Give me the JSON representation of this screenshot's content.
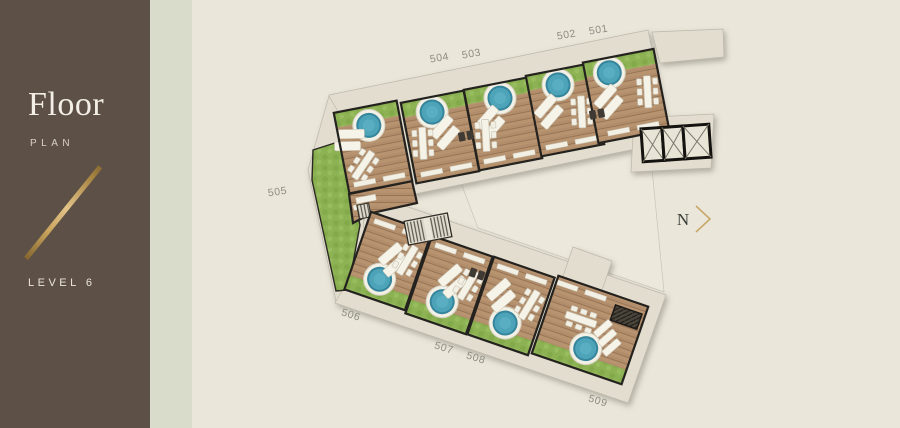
{
  "sidebar": {
    "title": "Floor",
    "subtitle": "PLAN",
    "level_label": "LEVEL 6"
  },
  "plan": {
    "north_label": "N",
    "units": [
      {
        "label": "501"
      },
      {
        "label": "502"
      },
      {
        "label": "503"
      },
      {
        "label": "504"
      },
      {
        "label": "505"
      },
      {
        "label": "506"
      },
      {
        "label": "507"
      },
      {
        "label": "508"
      },
      {
        "label": "509"
      }
    ]
  },
  "colors": {
    "sidebar_bg": "#5c5047",
    "accent_strip": "#d9dbcb",
    "canvas_bg": "#eae6d9",
    "walkway": "#e2ddcf",
    "deck_wood": "#b18d6b",
    "grass": "#8cb253",
    "hot_tub_water": "#4da3b7",
    "wall_line": "#24221e",
    "accent_gold": "#c9a86a",
    "label_gray": "#8e8c83"
  },
  "icons": {
    "north_chevron_icon": "›",
    "hot_tub_icon": "circle-pool",
    "lounger_icon": "sun-lounger",
    "dining_table_icon": "table-with-chairs",
    "bench_icon": "bench-strip",
    "bbq_icon": "grill",
    "stairs_icon": "hatched-stairs",
    "elevator_icon": "x-box",
    "pergola_icon": "hatched-canopy",
    "gold_divider_icon": "diagonal-line"
  }
}
